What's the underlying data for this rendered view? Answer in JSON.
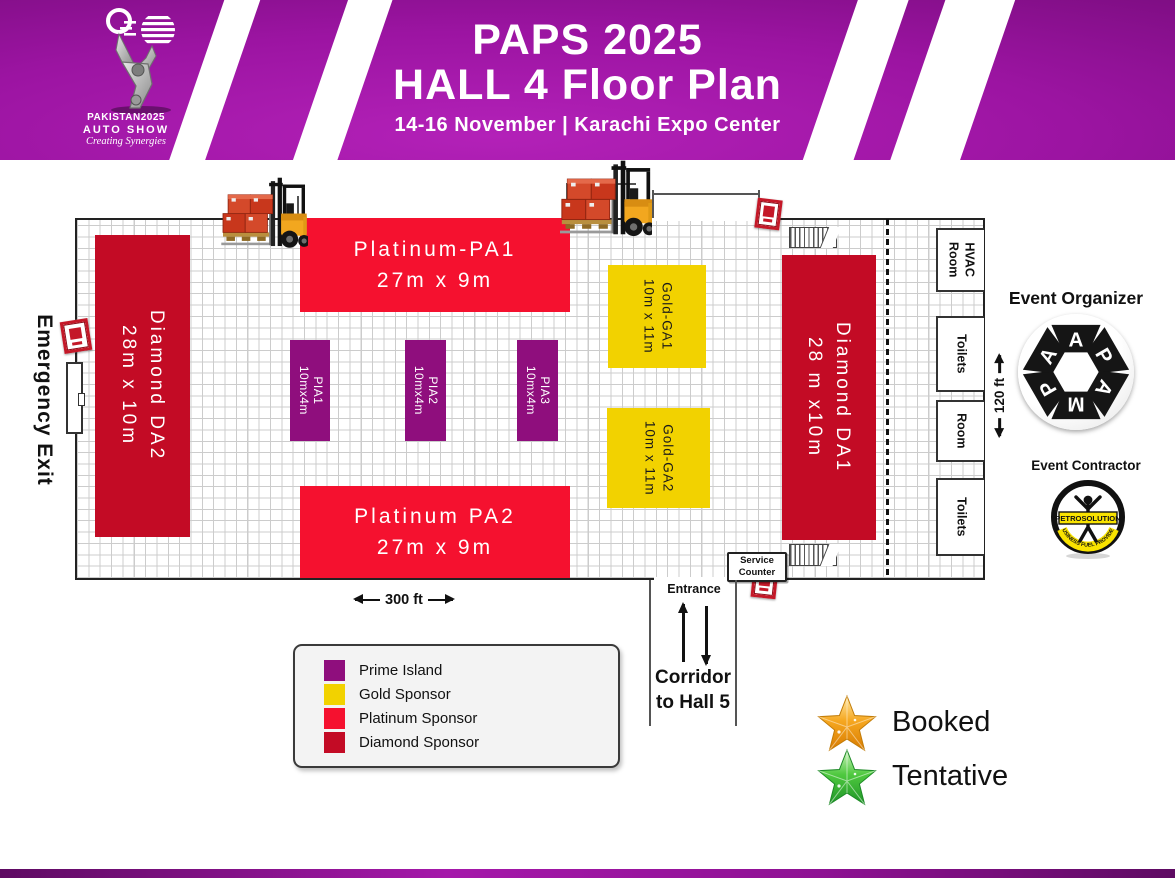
{
  "header": {
    "title_line1": "PAPS 2025",
    "title_line2": "HALL 4 Floor Plan",
    "subtitle": "14-16 November | Karachi Expo Center",
    "logo": {
      "name_line1": "PAKISTAN2025",
      "name_line2": "AUTO SHOW",
      "tagline": "Creating Synergies"
    }
  },
  "hall": {
    "booths": [
      {
        "id": "diamond-da2",
        "name": "Diamond DA2",
        "size": "28m x 10m",
        "category": "Diamond Sponsor"
      },
      {
        "id": "platinum-pa1",
        "name": "Platinum-PA1",
        "size": "27m x 9m",
        "category": "Platinum Sponsor"
      },
      {
        "id": "pia1",
        "name": "PIA1",
        "size": "10mx4m",
        "category": "Prime Island"
      },
      {
        "id": "pia2",
        "name": "PIA2",
        "size": "10mx4m",
        "category": "Prime Island"
      },
      {
        "id": "pia3",
        "name": "PIA3",
        "size": "10mx4m",
        "category": "Prime Island"
      },
      {
        "id": "gold-ga1",
        "name": "Gold-GA1",
        "size": "10m x 11m",
        "category": "Gold Sponsor"
      },
      {
        "id": "gold-ga2",
        "name": "Gold-GA2",
        "size": "10m x 11m",
        "category": "Gold Sponsor"
      },
      {
        "id": "platinum-pa2",
        "name": "Platinum PA2",
        "size": "27m x 9m",
        "category": "Platinum Sponsor"
      },
      {
        "id": "diamond-da1",
        "name": "Diamond DA1",
        "size": "28 m x10m",
        "category": "Diamond Sponsor"
      }
    ],
    "rooms": [
      {
        "line1": "HVAC",
        "line2": "Room"
      },
      {
        "line1": "Toilets",
        "line2": ""
      },
      {
        "line1": "Room",
        "line2": ""
      },
      {
        "line1": "Toilets",
        "line2": ""
      }
    ],
    "emergency_exit": "Emergency Exit",
    "service_counter": {
      "line1": "Service",
      "line2": "Counter"
    },
    "entrance": "Entrance",
    "corridor_line1": "Corridor",
    "corridor_line2": "to Hall 5",
    "width_label": "300 ft",
    "height_label": "120 ft"
  },
  "legend": {
    "items": [
      {
        "label": "Prime Island",
        "color": "#8F0E7D"
      },
      {
        "label": "Gold Sponsor",
        "color": "#F2D200"
      },
      {
        "label": "Platinum Sponsor",
        "color": "#F5112F"
      },
      {
        "label": "Diamond Sponsor",
        "color": "#C30B25"
      }
    ]
  },
  "status": {
    "booked": "Booked",
    "tentative": "Tentative"
  },
  "organizer": {
    "title": "Event Organizer",
    "letters": [
      "A",
      "P",
      "A",
      "M",
      "P",
      "A"
    ]
  },
  "contractor": {
    "title": "Event Contractor",
    "name": "PETROSOLUTION",
    "tagline": "BUSINESS FUEL PROVIDER"
  }
}
